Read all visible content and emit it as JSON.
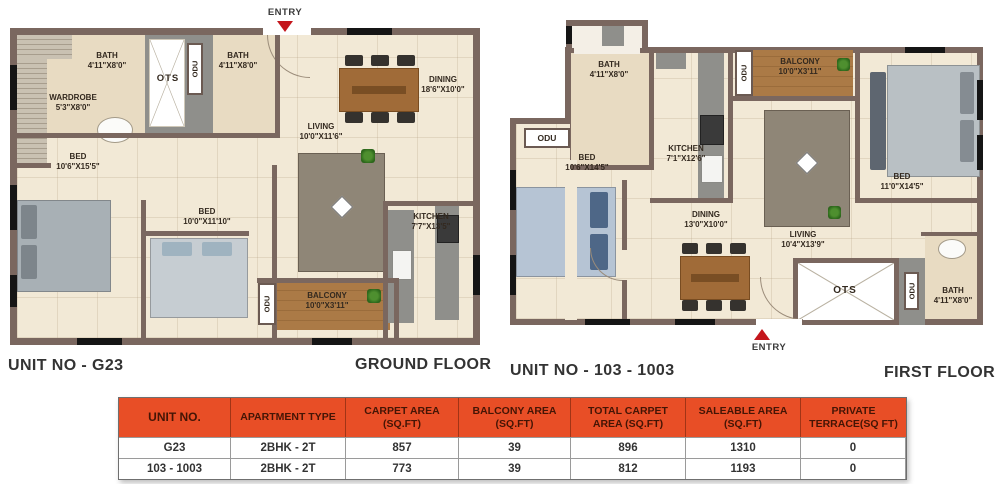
{
  "ground": {
    "entry": "ENTRY",
    "unit_no": "UNIT NO - G23",
    "floor": "GROUND FLOOR",
    "rooms": {
      "wardrobe": {
        "name": "WARDROBE",
        "dim": "5'3\"X8'0\""
      },
      "bath1": {
        "name": "BATH",
        "dim": "4'11\"X8'0\""
      },
      "ots": {
        "name": "OTS"
      },
      "odu_top": {
        "name": "ODU"
      },
      "bath2": {
        "name": "BATH",
        "dim": "4'11\"X8'0\""
      },
      "dining": {
        "name": "DINING",
        "dim": "18'6\"X10'0\""
      },
      "living": {
        "name": "LIVING",
        "dim": "10'0\"X11'6\""
      },
      "bed1": {
        "name": "BED",
        "dim": "10'6\"X15'5\""
      },
      "bed2": {
        "name": "BED",
        "dim": "10'0\"X11'10\""
      },
      "kitchen": {
        "name": "KITCHEN",
        "dim": "7'7\"X13'5\""
      },
      "balcony": {
        "name": "BALCONY",
        "dim": "10'0\"X3'11\""
      },
      "odu_balcony": {
        "name": "ODU"
      }
    }
  },
  "first": {
    "entry": "ENTRY",
    "unit_no": "UNIT NO - 103 - 1003",
    "floor": "FIRST FLOOR",
    "rooms": {
      "bath_top": {
        "name": "BATH",
        "dim": "4'11\"X8'0\""
      },
      "odu_left": {
        "name": "ODU"
      },
      "bed_left": {
        "name": "BED",
        "dim": "10'6\"X14'5\""
      },
      "kitchen": {
        "name": "KITCHEN",
        "dim": "7'1\"X12'6\""
      },
      "balcony": {
        "name": "BALCONY",
        "dim": "10'0\"X3'11\""
      },
      "odu_balcony": {
        "name": "ODU"
      },
      "bed_right": {
        "name": "BED",
        "dim": "11'0\"X14'5\""
      },
      "dining": {
        "name": "DINING",
        "dim": "13'0\"X10'0\""
      },
      "living": {
        "name": "LIVING",
        "dim": "10'4\"X13'9\""
      },
      "ots": {
        "name": "OTS"
      },
      "odu_ots": {
        "name": "ODU"
      },
      "bath_bottom": {
        "name": "BATH",
        "dim": "4'11\"X8'0\""
      }
    }
  },
  "table": {
    "headers": [
      "UNIT NO.",
      "APARTMENT TYPE",
      "CARPET AREA (SQ.FT)",
      "BALCONY AREA (SQ.FT)",
      "TOTAL CARPET AREA (SQ.FT)",
      "SALEABLE AREA (SQ.FT)",
      "PRIVATE TERRACE(SQ FT)"
    ],
    "rows": [
      [
        "G23",
        "2BHK - 2T",
        "857",
        "39",
        "896",
        "1310",
        "0"
      ],
      [
        "103 - 1003",
        "2BHK - 2T",
        "773",
        "39",
        "812",
        "1193",
        "0"
      ]
    ]
  },
  "colors": {
    "wall": "#7a675f",
    "floor": "#f2e9d6",
    "bath": "#e8dbc2",
    "balcony_wood": "#ab7a46",
    "entry_red": "#c4161c",
    "table_header_bg": "#e84e26",
    "table_header_text": "#441505",
    "counter_gray": "#8f8f8b"
  }
}
